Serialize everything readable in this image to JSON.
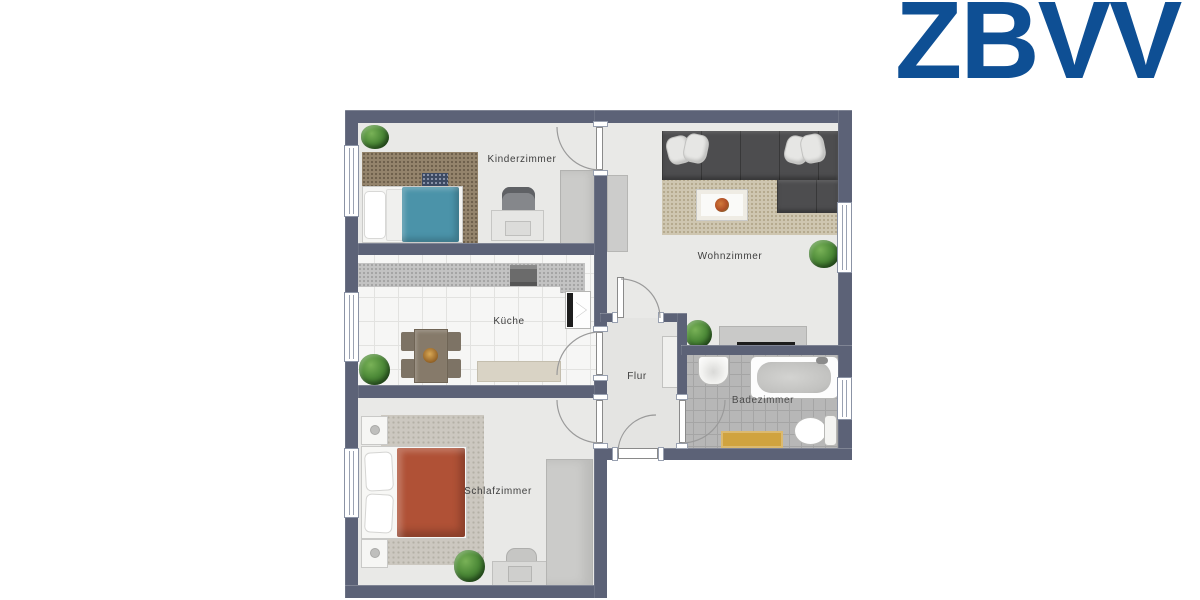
{
  "brand": {
    "logo_text": "ZBVV",
    "logo_color": "#0e4f94"
  },
  "floor_plan": {
    "type": "apartment-floor-plan",
    "rooms": {
      "kinderzimmer": {
        "label": "Kinderzimmer"
      },
      "wohnzimmer": {
        "label": "Wohnzimmer"
      },
      "kueche": {
        "label": "Küche"
      },
      "flur": {
        "label": "Flur"
      },
      "schlafzimmer": {
        "label": "Schlafzimmer"
      },
      "badezimmer": {
        "label": "Badezimmer"
      }
    },
    "colors": {
      "wall": "#5c6277",
      "room_floor": "#e9e9e7",
      "bath_tile": "#b7b7b7",
      "kinder_blanket": "#4b93a9",
      "schlaf_blanket": "#b05136",
      "sofa": "#4d4d4f",
      "bath_mat": "#d0a33f",
      "plant": "#3f7c33"
    }
  }
}
